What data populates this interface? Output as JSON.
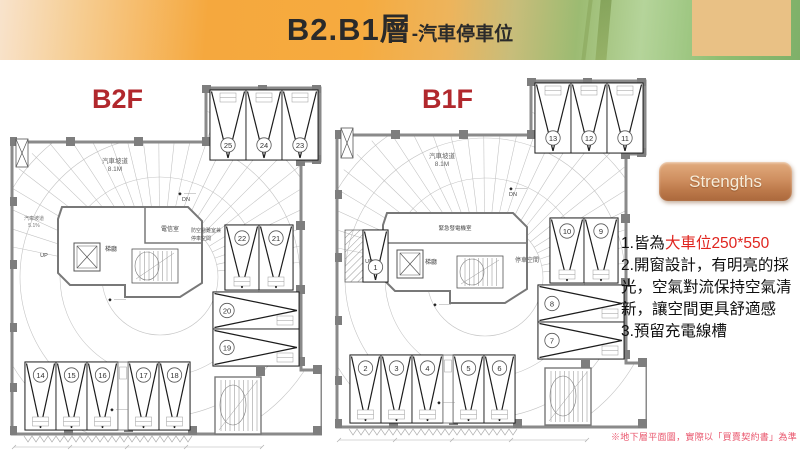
{
  "banner": {
    "title_main": "B2.B1層",
    "title_sub": "-汽車停車位"
  },
  "plans": [
    {
      "id": "b2f",
      "label": "B2F",
      "ramp_label": "汽車坡道",
      "ramp_height": "8.1M",
      "slope_label": "汽車坡道",
      "slope_value": "5.1%",
      "up": "UP",
      "dn": "DN",
      "rooms": {
        "room1": "電信室",
        "lobby": "梯廳",
        "shelter_line1": "防空避難室兼",
        "shelter_line2": "停車空間"
      },
      "stalls": {
        "top": [
          "25",
          "24",
          "23"
        ],
        "right_vertical": [
          "22",
          "21"
        ],
        "right_horizontal": [
          "20",
          "19"
        ],
        "bottom_left": [
          "14",
          "15",
          "16"
        ],
        "bottom_right": [
          "17",
          "18"
        ],
        "extra": []
      }
    },
    {
      "id": "b1f",
      "label": "B1F",
      "ramp_label": "汽車坡道",
      "ramp_height": "8.1M",
      "up": "UP",
      "dn": "DN",
      "rooms": {
        "room1": "緊急發電機室",
        "lobby": "梯廳",
        "parking_space": "停車空間"
      },
      "stalls": {
        "top": [
          "13",
          "12",
          "11"
        ],
        "right_vertical": [
          "10",
          "9"
        ],
        "right_horizontal": [
          "8",
          "7"
        ],
        "bottom_left": [
          "2",
          "3",
          "4"
        ],
        "bottom_right": [
          "5",
          "6"
        ],
        "extra": [
          "1"
        ]
      }
    }
  ],
  "strengths": {
    "button_label": "Strengths",
    "items": [
      {
        "prefix": "1.皆為",
        "highlight": "大車位250*550"
      },
      {
        "text": "2.開窗設計，有明亮的採光，空氣對流保持空氣清新，讓空間更具舒適感"
      },
      {
        "text": "3.預留充電線槽"
      }
    ]
  },
  "footnote": "※地下層平面圖，實際以「買賣契約書」為準",
  "colors": {
    "title_dark": "#2a2a2a",
    "plan_label_red": "#b1282d",
    "highlight_red": "#e0251f",
    "footnote_red": "#e9546b",
    "button_tan": "#c9875b",
    "banner_orange": "#f5a83e",
    "banner_green": "#8fbe72",
    "banner_tan_box": "#e9c185"
  }
}
